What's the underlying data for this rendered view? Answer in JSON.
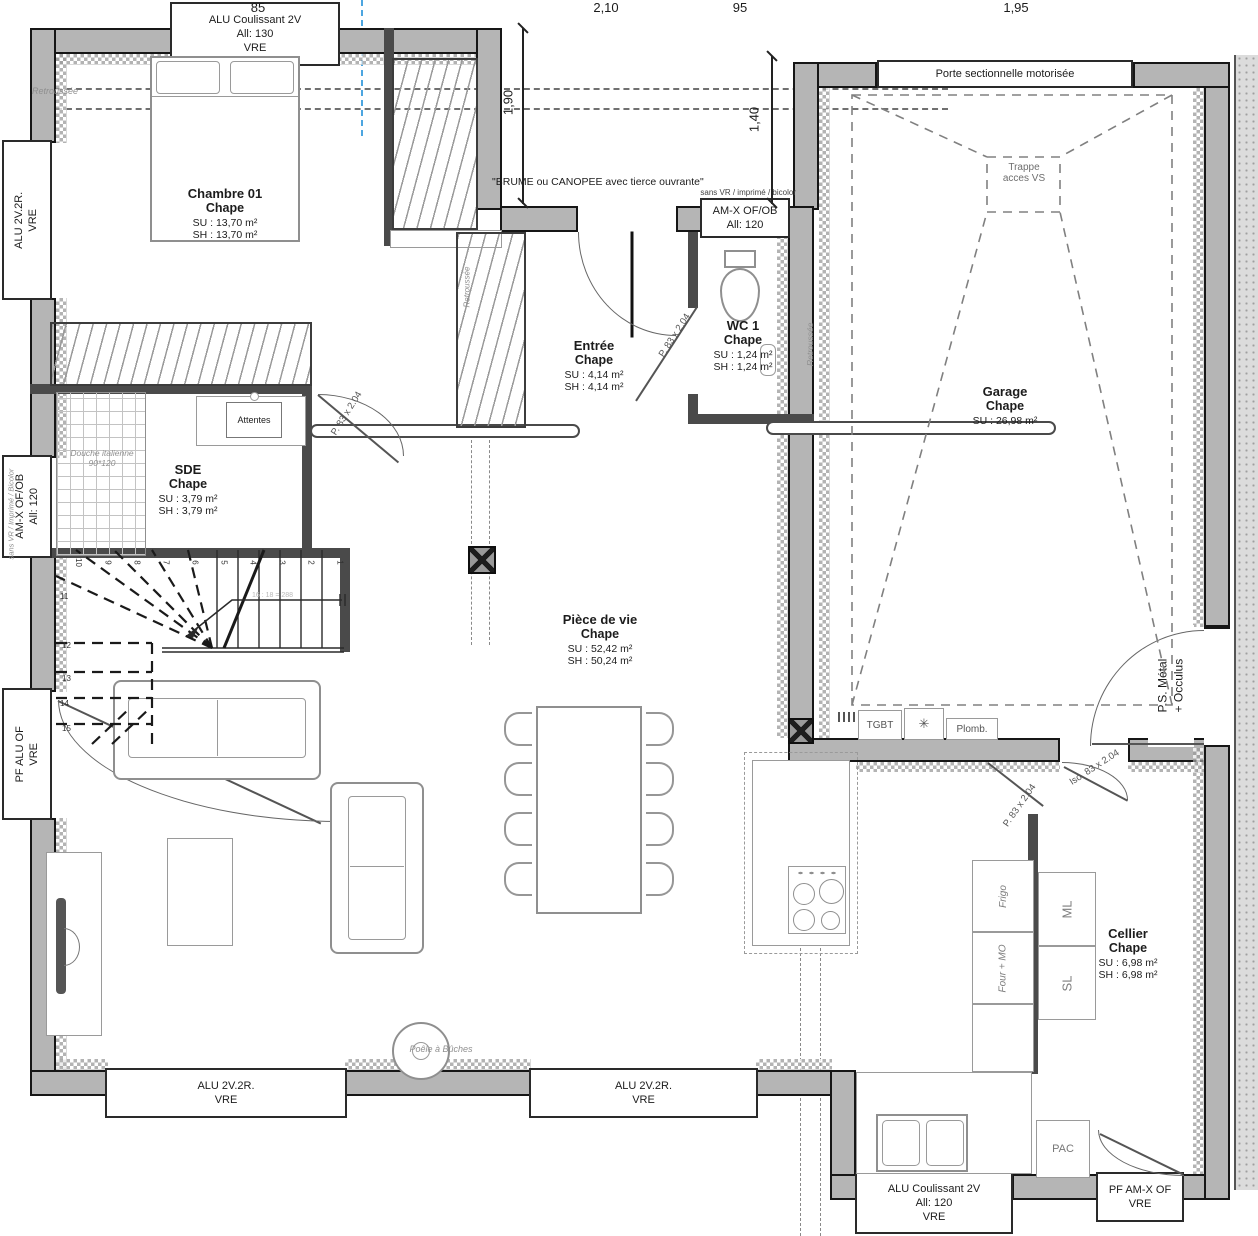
{
  "palette": {
    "wall_gray": "#b5b5b5",
    "line_black": "#161616",
    "furniture_gray": "#8f8f8f",
    "annotation_gray": "#8f8f8f",
    "axis_blue": "#4da6e0"
  },
  "dimensions": {
    "top": [
      "85",
      "2,10",
      "95",
      "1,95"
    ],
    "left_vertical": "1,90",
    "right_vertical": "1,40"
  },
  "rooms": [
    {
      "name": "Chambre 01",
      "finish": "Chape",
      "su": "SU : 13,70 m²",
      "sh": "SH : 13,70 m²"
    },
    {
      "name": "Entrée",
      "finish": "Chape",
      "su": "SU : 4,14 m²",
      "sh": "SH : 4,14 m²"
    },
    {
      "name": "WC 1",
      "finish": "Chape",
      "su": "SU : 1,24 m²",
      "sh": "SH : 1,24 m²"
    },
    {
      "name": "SDE",
      "finish": "Chape",
      "su": "SU : 3,79 m²",
      "sh": "SH : 3,79 m²"
    },
    {
      "name": "Garage",
      "finish": "Chape",
      "su": "SU : 26,98 m²"
    },
    {
      "name": "Pièce de vie",
      "finish": "Chape",
      "su": "SU : 52,42 m²",
      "sh": "SH : 50,24 m²"
    },
    {
      "name": "Cellier",
      "finish": "Chape",
      "su": "SU : 6,98 m²",
      "sh": "SH : 6,98 m²"
    }
  ],
  "windows": {
    "top": {
      "line1": "ALU Coulissant 2V",
      "line2": "All: 130",
      "line3": "VRE"
    },
    "left_top": {
      "line1": "ALU 2V.2R.",
      "line2": "VRE"
    },
    "left_mid": {
      "line1": "AM-X OF/OB",
      "line2": "All: 120"
    },
    "left_bottom": {
      "line1": "PF ALU OF",
      "line2": "VRE"
    },
    "wc": {
      "line1": "AM-X OF/OB",
      "line2": "All: 120"
    },
    "bottom_left": {
      "line1": "ALU 2V.2R.",
      "line2": "VRE"
    },
    "bottom_center": {
      "line1": "ALU 2V.2R.",
      "line2": "VRE"
    },
    "cellier_bottom": {
      "line1": "ALU Coulissant 2V",
      "line2": "All: 120",
      "line3": "VRE"
    },
    "bottom_right": {
      "line1": "PF AM-X OF",
      "line2": "VRE"
    }
  },
  "doors": {
    "garage_sectional": "Porte sectionnelle motorisée",
    "garage_side_line1": "P.S. Métal",
    "garage_side_line2": "+ Occulus",
    "interior": "P. 83 x 2.04",
    "insulated": "Iso. 83 x 2.04"
  },
  "annotations": {
    "retroussee": "Retroussée",
    "brume": "\"BRUME ou CANOPEE avec tierce ouvrante\"",
    "sans_vr": "sans VR / imprimé / bicolor",
    "sans_vr_left": "sans VR / Imprimé / Bicolor",
    "trappe_line1": "Trappe",
    "trappe_line2": "acces VS",
    "attentes": "Attentes",
    "douche_line1": "Douche italienne",
    "douche_line2": "90*120",
    "poele": "Poêle à Bûches",
    "tgbt": "TGBT",
    "plomb": "Plomb.",
    "pac": "PAC",
    "stair_note": "16 : 18 = 288"
  },
  "appliances": {
    "frigo": "Frigo",
    "four_mo": "Four + MO",
    "ml": "ML",
    "sl": "SL"
  },
  "stairs": {
    "numbers": [
      "1",
      "2",
      "3",
      "4",
      "5",
      "6",
      "7",
      "8",
      "9",
      "10",
      "11",
      "12",
      "13",
      "14",
      "15"
    ]
  }
}
